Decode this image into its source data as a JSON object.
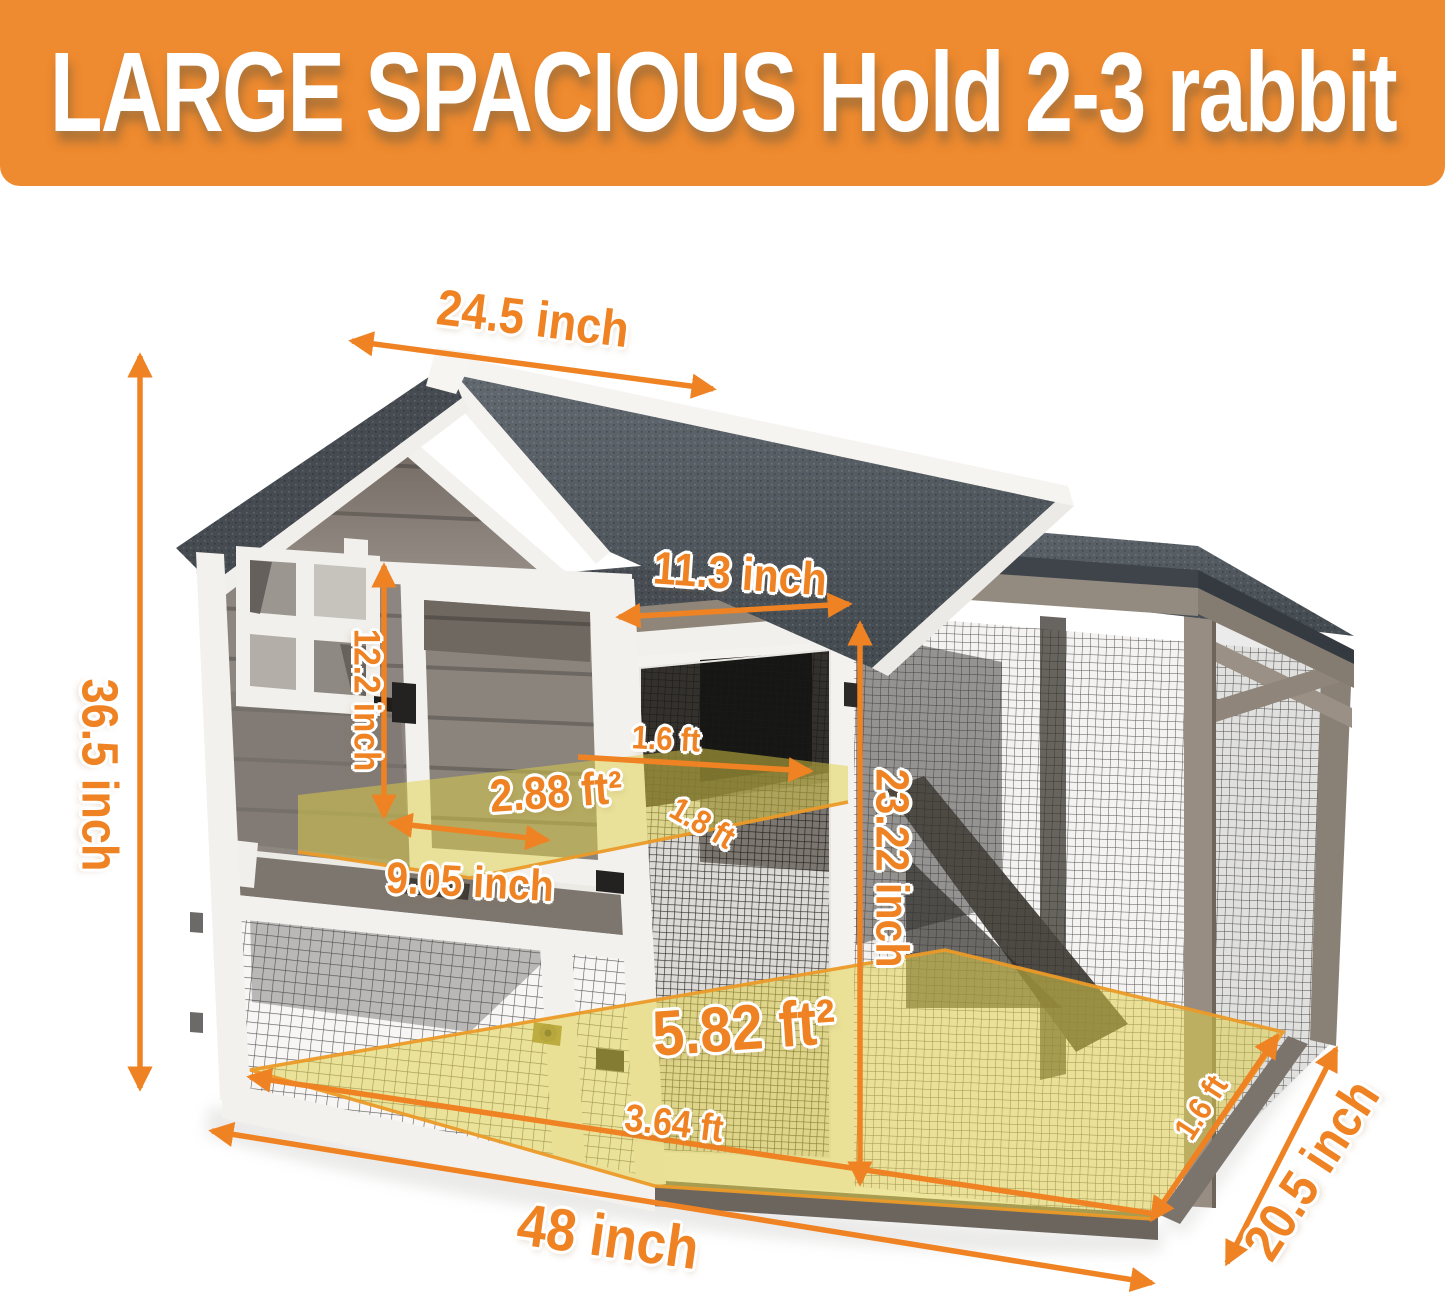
{
  "banner": {
    "title": "LARGE SPACIOUS Hold 2-3 rabbit"
  },
  "colors": {
    "banner-bg": "#ee8a2f",
    "accent": "#ef8222",
    "overlay-yellow": "#e0cf45",
    "overlay-border": "#eb9a28"
  },
  "dimensions": {
    "roof_width": {
      "label": "24.5 inch"
    },
    "total_height": {
      "label": "36.5 inch"
    },
    "run_door_width": {
      "label": "11.3 inch"
    },
    "house_door_height": {
      "label": "12.2 inch"
    },
    "shelf_depth": {
      "label": "1.6 ft"
    },
    "shelf_area": {
      "label": "2.88 ft²"
    },
    "shelf_width": {
      "label": "9.05 inch"
    },
    "shelf_diagonal": {
      "label": "1.8 ft"
    },
    "run_height": {
      "label": "23.22 inch"
    },
    "floor_area": {
      "label": "5.82 ft²"
    },
    "floor_front": {
      "label": "3.64 ft"
    },
    "total_width": {
      "label": "48 inch"
    },
    "floor_side": {
      "label": "1.6 ft"
    },
    "total_depth": {
      "label": "20.5 inch"
    }
  }
}
